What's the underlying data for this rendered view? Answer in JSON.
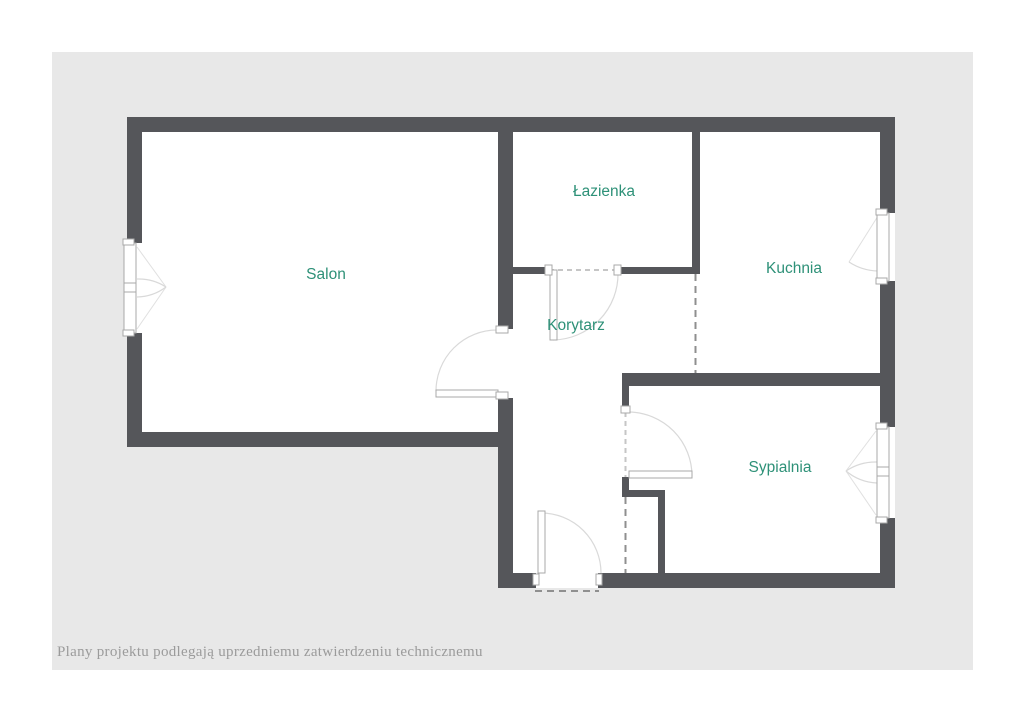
{
  "palette": {
    "wall_color": "#55565a",
    "canvas_background": "#e8e8e8",
    "room_fill": "#ffffff",
    "label_color": "#2e9178",
    "caption_color": "#9b9b9b"
  },
  "rooms": {
    "salon": {
      "label": "Salon"
    },
    "lazienka": {
      "label": "Łazienka"
    },
    "kuchnia": {
      "label": "Kuchnia"
    },
    "korytarz": {
      "label": "Korytarz"
    },
    "sypialnia": {
      "label": "Sypialnia"
    }
  },
  "caption": {
    "text": "Plany projektu podlegają uprzedniemu zatwierdzeniu technicznemu"
  }
}
